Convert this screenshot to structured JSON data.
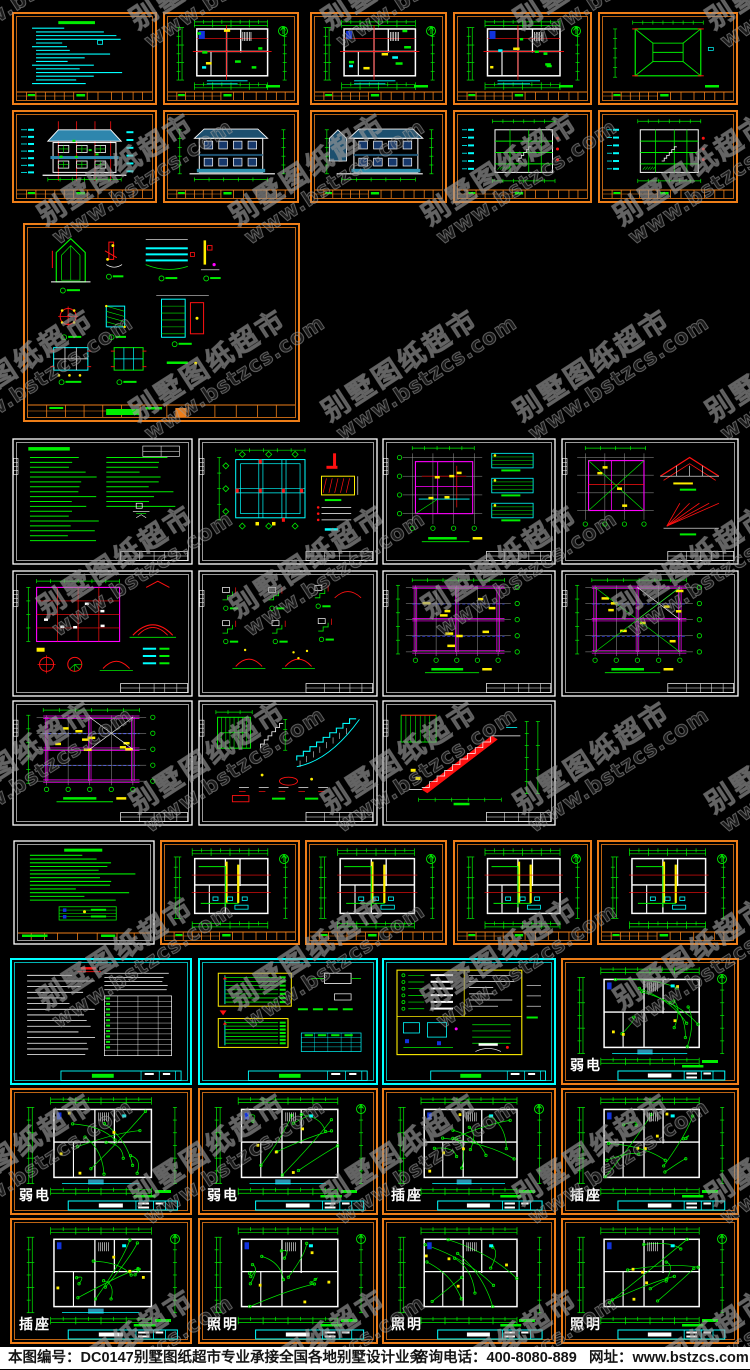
{
  "page": {
    "width": 750,
    "height": 1369,
    "background": "#000000"
  },
  "watermark": {
    "line1": "别墅图纸超市",
    "line2": "www.bstzcs.com",
    "angle_deg": -33,
    "color": "#9a9a9a"
  },
  "footer": {
    "sheet_number": "本图编号：DC0147",
    "slogan": "别墅图纸超市专业承接全国各地别墅设计业务",
    "phone": "咨询电话：400-8080-889",
    "website": "网址：www.bstzcs.com",
    "background": "#ffffff",
    "text_color": "#151515"
  },
  "palette": {
    "orange": "#ee7e18",
    "green": "#00ee00",
    "cyan": "#00ffff",
    "red": "#ff1111",
    "magenta": "#ff00ff",
    "yellow": "#ffee00",
    "white": "#ffffff",
    "blue": "#3344ff",
    "grid": "#9a9a9a",
    "teal": "#2e86ad",
    "navy": "#1c4f6e",
    "window": "#16386b",
    "porch": "#2d8fae",
    "panel_blue": "#1133dd",
    "black": "#000000"
  },
  "sections": [
    {
      "id": "architectural",
      "description": "building plans, elevations, sections, detail sheet"
    },
    {
      "id": "structural",
      "description": "foundation, framing, beam and stair structure sheets"
    },
    {
      "id": "plumbing",
      "description": "water supply and drainage plans"
    },
    {
      "id": "electrical",
      "description": "notes, system diagrams, weak-current, socket and lighting plans"
    }
  ],
  "sheets": [
    {
      "id": "arch-notes",
      "section": "architectural",
      "type": "notes-cyan",
      "border": "orange",
      "x": 12,
      "y": 12,
      "w": 145,
      "h": 93
    },
    {
      "id": "arch-plan-1f",
      "section": "architectural",
      "type": "arch-plan",
      "border": "orange",
      "x": 163,
      "y": 12,
      "w": 136,
      "h": 93
    },
    {
      "id": "arch-plan-2f",
      "section": "architectural",
      "type": "arch-plan",
      "border": "orange",
      "x": 310,
      "y": 12,
      "w": 137,
      "h": 93
    },
    {
      "id": "arch-plan-3f",
      "section": "architectural",
      "type": "arch-plan",
      "border": "orange",
      "x": 453,
      "y": 12,
      "w": 139,
      "h": 93
    },
    {
      "id": "arch-roof-plan",
      "section": "architectural",
      "type": "roof-plan",
      "border": "orange",
      "x": 598,
      "y": 12,
      "w": 140,
      "h": 93
    },
    {
      "id": "arch-elev-front",
      "section": "architectural",
      "type": "elev-color",
      "border": "orange",
      "x": 12,
      "y": 110,
      "w": 145,
      "h": 93
    },
    {
      "id": "arch-elev-back",
      "section": "architectural",
      "type": "elev-white",
      "border": "orange",
      "x": 163,
      "y": 110,
      "w": 136,
      "h": 93
    },
    {
      "id": "arch-elev-side",
      "section": "architectural",
      "type": "elev-white",
      "border": "orange",
      "x": 310,
      "y": 110,
      "w": 137,
      "h": 93
    },
    {
      "id": "arch-section-1",
      "section": "architectural",
      "type": "section-green",
      "border": "orange",
      "x": 453,
      "y": 110,
      "w": 139,
      "h": 93
    },
    {
      "id": "arch-section-2",
      "section": "architectural",
      "type": "section-green",
      "border": "orange",
      "x": 598,
      "y": 110,
      "w": 140,
      "h": 93
    },
    {
      "id": "arch-details",
      "section": "architectural",
      "type": "arch-details",
      "border": "orange",
      "x": 23,
      "y": 223,
      "w": 277,
      "h": 199
    },
    {
      "id": "struct-notes",
      "section": "structural",
      "type": "notes-green",
      "border": "white",
      "x": 12,
      "y": 438,
      "w": 181,
      "h": 127
    },
    {
      "id": "struct-foundation",
      "section": "structural",
      "type": "struct-foundation",
      "border": "white",
      "x": 198,
      "y": 438,
      "w": 180,
      "h": 127
    },
    {
      "id": "struct-frame-1",
      "section": "structural",
      "type": "struct-frame",
      "border": "white",
      "x": 382,
      "y": 438,
      "w": 174,
      "h": 127
    },
    {
      "id": "struct-frame-2",
      "section": "structural",
      "type": "struct-frame-roof",
      "border": "white",
      "x": 561,
      "y": 438,
      "w": 178,
      "h": 127
    },
    {
      "id": "struct-frame-3",
      "section": "structural",
      "type": "struct-frame-dense",
      "border": "white",
      "x": 12,
      "y": 570,
      "w": 181,
      "h": 127
    },
    {
      "id": "struct-details",
      "section": "structural",
      "type": "struct-details",
      "border": "white",
      "x": 198,
      "y": 570,
      "w": 180,
      "h": 127
    },
    {
      "id": "struct-beam-1",
      "section": "structural",
      "type": "beam-plan",
      "border": "white",
      "x": 382,
      "y": 570,
      "w": 174,
      "h": 127
    },
    {
      "id": "struct-beam-2",
      "section": "structural",
      "type": "beam-plan",
      "border": "white",
      "x": 561,
      "y": 570,
      "w": 178,
      "h": 127
    },
    {
      "id": "struct-beam-3",
      "section": "structural",
      "type": "beam-plan",
      "border": "white",
      "x": 12,
      "y": 700,
      "w": 181,
      "h": 126
    },
    {
      "id": "struct-stair-1",
      "section": "structural",
      "type": "stair-details",
      "border": "white",
      "x": 198,
      "y": 700,
      "w": 180,
      "h": 126
    },
    {
      "id": "struct-stair-2",
      "section": "structural",
      "type": "stair-section",
      "border": "white",
      "x": 382,
      "y": 700,
      "w": 174,
      "h": 126
    },
    {
      "id": "plumb-notes",
      "section": "plumbing",
      "type": "notes-green",
      "border": "white-orange",
      "x": 13,
      "y": 840,
      "w": 142,
      "h": 105
    },
    {
      "id": "plumb-plan-1f",
      "section": "plumbing",
      "type": "plumb-plan",
      "border": "orange",
      "x": 160,
      "y": 840,
      "w": 140,
      "h": 105
    },
    {
      "id": "plumb-plan-2f",
      "section": "plumbing",
      "type": "plumb-plan",
      "border": "orange",
      "x": 305,
      "y": 840,
      "w": 142,
      "h": 105
    },
    {
      "id": "plumb-plan-3f",
      "section": "plumbing",
      "type": "plumb-plan",
      "border": "orange",
      "x": 453,
      "y": 840,
      "w": 139,
      "h": 105
    },
    {
      "id": "plumb-plan-roof",
      "section": "plumbing",
      "type": "plumb-plan",
      "border": "orange",
      "x": 597,
      "y": 840,
      "w": 141,
      "h": 105
    },
    {
      "id": "elec-notes",
      "section": "electrical",
      "type": "notes-white",
      "border": "cyan",
      "x": 10,
      "y": 958,
      "w": 182,
      "h": 127
    },
    {
      "id": "elec-system",
      "section": "electrical",
      "type": "elec-system",
      "border": "cyan",
      "x": 198,
      "y": 958,
      "w": 180,
      "h": 127
    },
    {
      "id": "elec-legend",
      "section": "electrical",
      "type": "elec-legend",
      "border": "cyan",
      "x": 382,
      "y": 958,
      "w": 174,
      "h": 127
    },
    {
      "id": "elec-weak-1",
      "section": "electrical",
      "type": "elec-plan",
      "border": "orange",
      "label": "弱电",
      "x": 561,
      "y": 958,
      "w": 178,
      "h": 127
    },
    {
      "id": "elec-weak-2",
      "section": "electrical",
      "type": "elec-plan",
      "border": "orange",
      "label": "弱电",
      "x": 10,
      "y": 1088,
      "w": 182,
      "h": 127
    },
    {
      "id": "elec-weak-3",
      "section": "electrical",
      "type": "elec-plan",
      "border": "orange",
      "label": "弱电",
      "x": 198,
      "y": 1088,
      "w": 180,
      "h": 127
    },
    {
      "id": "elec-socket-1",
      "section": "electrical",
      "type": "elec-plan",
      "border": "orange",
      "label": "插座",
      "x": 382,
      "y": 1088,
      "w": 174,
      "h": 127
    },
    {
      "id": "elec-socket-2",
      "section": "electrical",
      "type": "elec-plan",
      "border": "orange",
      "label": "插座",
      "x": 561,
      "y": 1088,
      "w": 178,
      "h": 127
    },
    {
      "id": "elec-socket-3",
      "section": "electrical",
      "type": "elec-plan",
      "border": "orange",
      "label": "插座",
      "x": 10,
      "y": 1218,
      "w": 182,
      "h": 126
    },
    {
      "id": "elec-light-1",
      "section": "electrical",
      "type": "elec-plan",
      "border": "orange",
      "label": "照明",
      "x": 198,
      "y": 1218,
      "w": 180,
      "h": 126
    },
    {
      "id": "elec-light-2",
      "section": "electrical",
      "type": "elec-plan",
      "border": "orange",
      "label": "照明",
      "x": 382,
      "y": 1218,
      "w": 174,
      "h": 126
    },
    {
      "id": "elec-light-3",
      "section": "electrical",
      "type": "elec-plan",
      "border": "orange",
      "label": "照明",
      "x": 561,
      "y": 1218,
      "w": 178,
      "h": 126
    }
  ]
}
